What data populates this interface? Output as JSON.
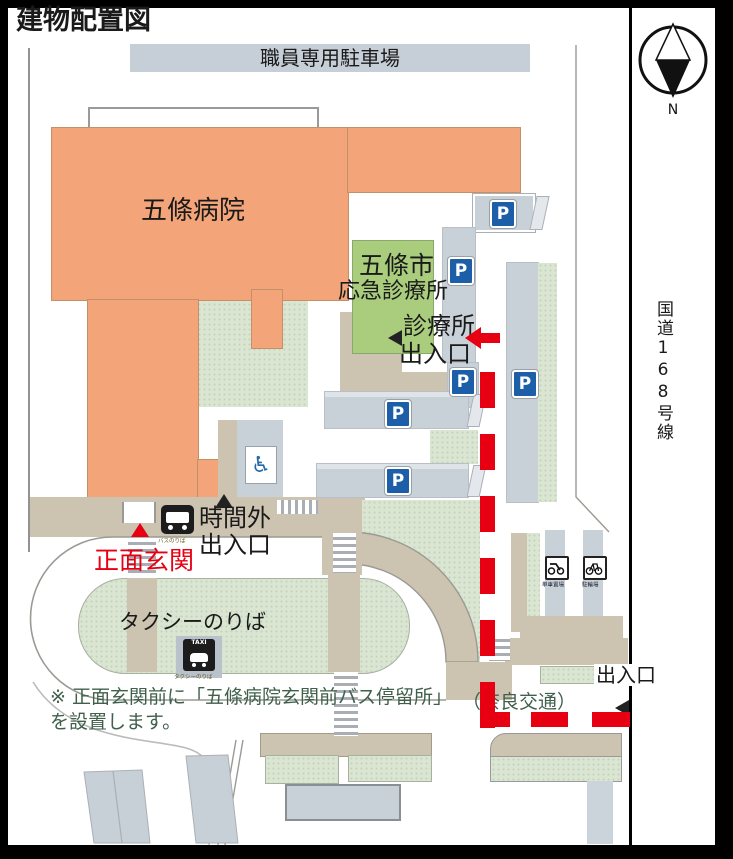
{
  "title": "建物配置図",
  "labels": {
    "staff_parking": "職員専用駐車場",
    "hospital": "五條病院",
    "clinic_l1": "五條市",
    "clinic_l2": "応急診療所",
    "clinic_entrance_l1": "診療所",
    "clinic_entrance_l2": "出入口",
    "after_hours_l1": "時間外",
    "after_hours_l2": "出入口",
    "main_entrance": "正面玄関",
    "taxi_stand": "タクシーのりば",
    "east_exit": "出入口",
    "bus_operator": "（奈良交通）",
    "route": "国道168号線",
    "note_l1": "※ 正面玄関前に「五條病院玄関前バス停留所」",
    "note_l2": "を設置します。"
  },
  "icons": {
    "parking": "P",
    "taxi": "TAXI",
    "wheelchair": "♿",
    "compass_north": "N",
    "bus_stop_caption": "バスのりば",
    "taxi_stand_caption": "タクシーのりば",
    "motorcycle_caption": "単車置場",
    "bicycle_caption": "駐輪場"
  },
  "colors": {
    "building_orange": "#F3A579",
    "clinic_green": "#A9CC7D",
    "lawn_green": "#DAE5D2",
    "ground_tan": "#CCC3B0",
    "parking_gray": "#C9D1D8",
    "parking_blue": "#1C5FA8",
    "route_red": "#E60012",
    "note_green": "#40604C"
  }
}
